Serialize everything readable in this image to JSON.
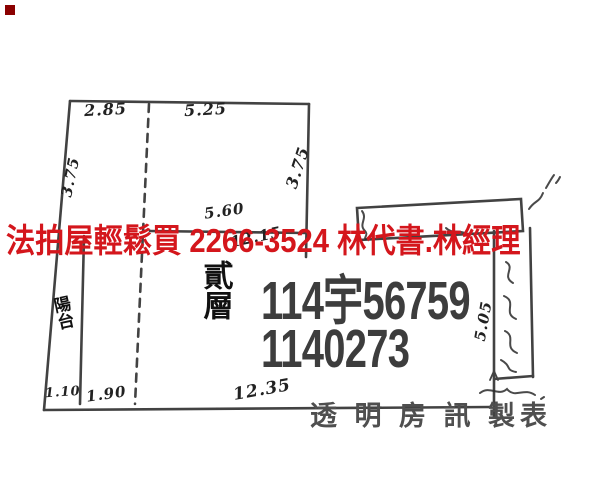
{
  "meta": {
    "background": "#ffffff",
    "ink_color": "#333333",
    "red_overlay_color": "#d4161c",
    "stamp_color": "#3d3d3d",
    "footer_color": "#4f4f4f",
    "corner_mark_color": "#8b0000"
  },
  "overlay": {
    "ad_text": "法拍屋輕鬆買  2266-3524  林代書.林經理"
  },
  "stamp": {
    "line1": "114宇56759",
    "line2": "1140273"
  },
  "footer": {
    "publisher": "透 明 房 訊 製表"
  },
  "floor_plan": {
    "floor_label": "貳層",
    "balcony_label": "陽台",
    "measurements": {
      "top_left_width": "2.85",
      "top_right_width": "5.25",
      "left_height": "3.75",
      "right_height": "3.75",
      "interior_width": "5.60",
      "interior_total_width": "12.15",
      "bottom_balcony_width": "1.10",
      "bottom_left_width": "1.90",
      "bottom_total_width": "12.35",
      "annex_height": "5.05"
    }
  }
}
